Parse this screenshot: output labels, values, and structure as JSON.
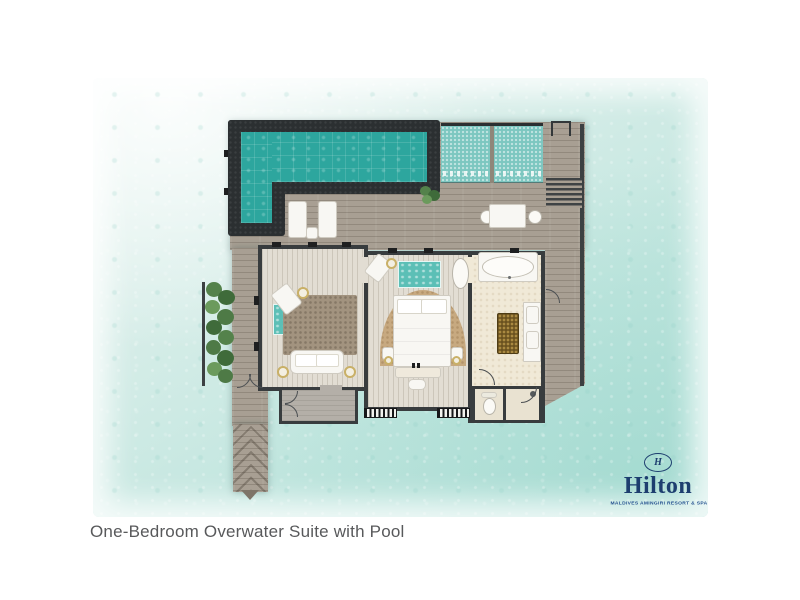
{
  "caption": "One-Bedroom Overwater Suite with Pool",
  "brand": {
    "monogram": "H",
    "name": "Hilton",
    "tagline": "MALDIVES AMINGIRI RESORT & SPA"
  },
  "palette": {
    "water_light": "#e9f5f1",
    "water_deep": "#b5e0d8",
    "pool_water": "#2da69e",
    "pool_frame": "#2b2f31",
    "net_teal": "#7cc7c0",
    "deck_wood": "#a89f93",
    "wall_dark": "#383c3e",
    "wood_floor": "#e2ddd3",
    "bath_floor": "#f0e9d7",
    "rug_brown": "#a2937f",
    "arch_rug_tan": "#c7a980",
    "vanity_gold": "#6b521f",
    "greenery_green": "#4e7a46",
    "brand_navy": "#1d3e6f",
    "caption_gray": "#58595b"
  },
  "plan": {
    "features": [
      "swimming-pool",
      "catamaran-nets",
      "sun-deck",
      "sun-loungers",
      "outdoor-dining-table",
      "water-access-stairs",
      "swim-ladder",
      "living-room",
      "sofa",
      "lounge-chairs",
      "area-rug",
      "glass-floor-panels",
      "bedroom",
      "king-bed",
      "arched-rug",
      "bathroom",
      "bathtub",
      "freestanding-basin",
      "double-vanity",
      "vanity-island",
      "wc",
      "shower",
      "entry-vestibule",
      "jetty-walkway",
      "access-bridge",
      "greenery"
    ]
  }
}
